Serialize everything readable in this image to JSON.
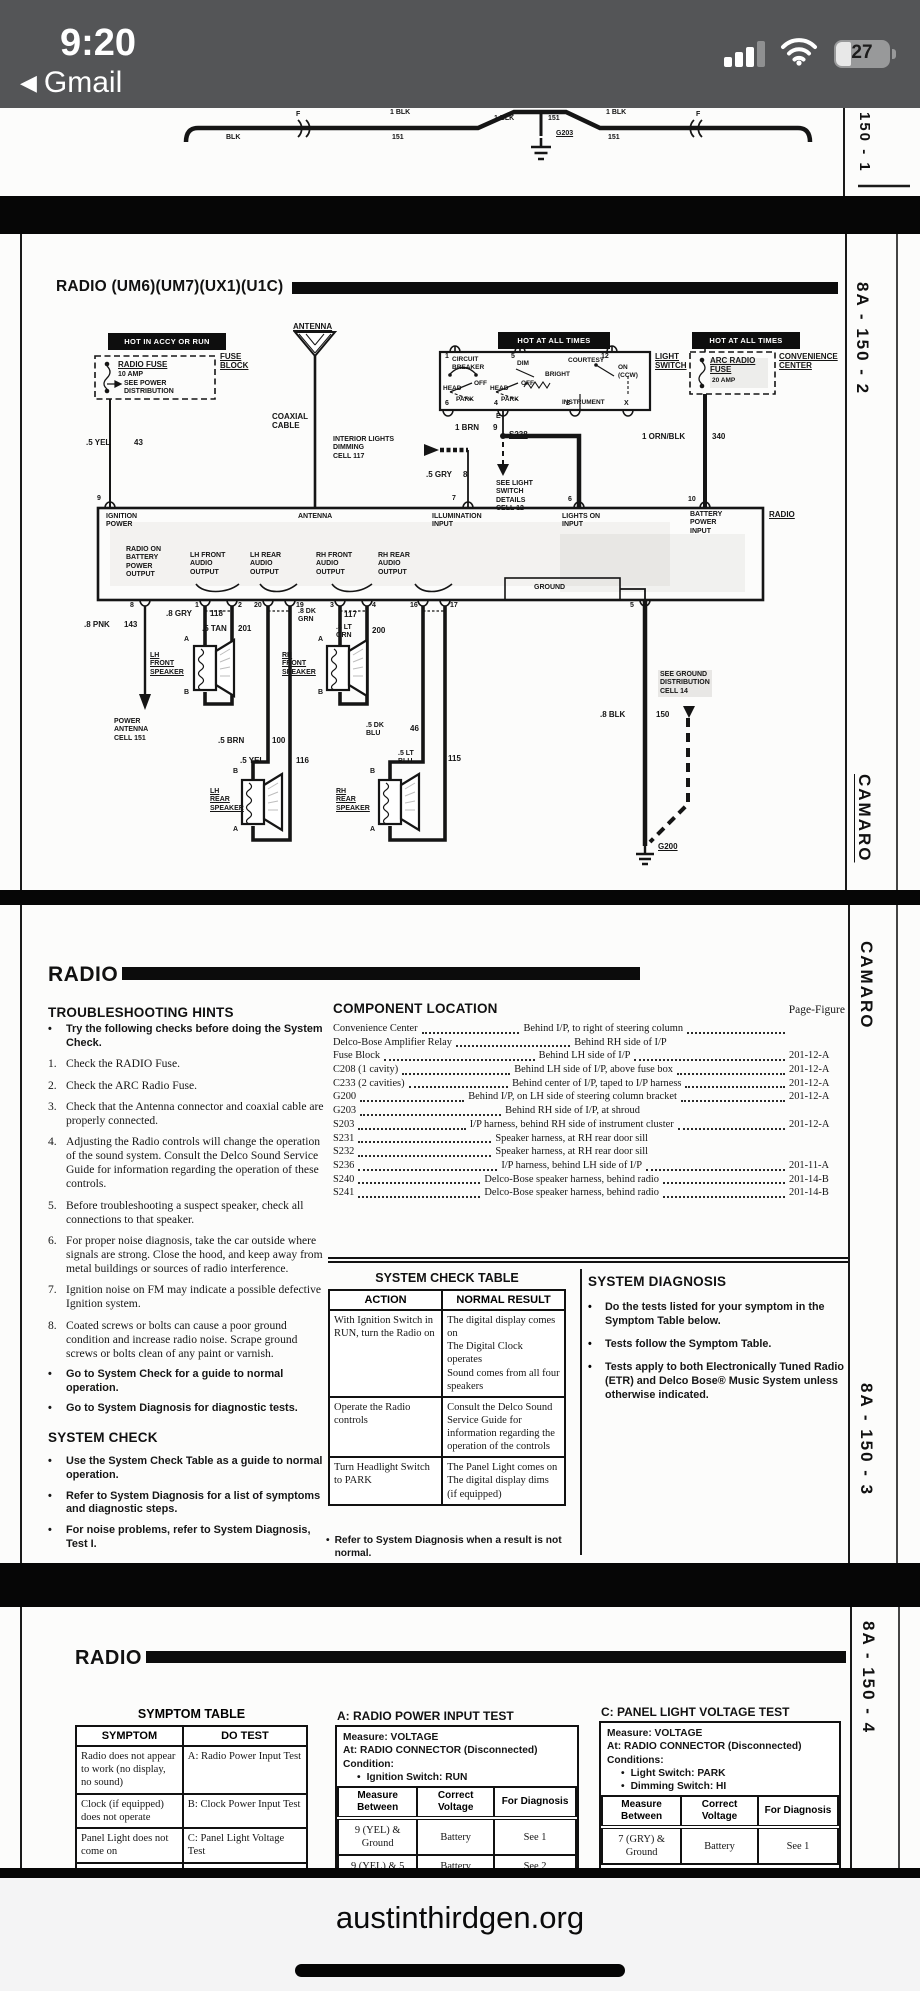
{
  "bullet": "•",
  "status": {
    "time": "9:20",
    "back": "Gmail",
    "battery": "27"
  },
  "bottom": {
    "url": "austinthirdgen.org"
  },
  "p1": {
    "page": "150 - 1",
    "f": "F",
    "blk": "BLK",
    "blk1": "1 BLK",
    "c151": "151",
    "g203": "G203"
  },
  "p2": {
    "title": "RADIO (UM6)(UM7)(UX1)(U1C)",
    "page": "8A - 150 - 2",
    "camaro": "CAMARO",
    "d": {
      "hot_accy": "HOT IN ACCY OR RUN",
      "fuse_block": "FUSE\nBLOCK",
      "radio_fuse": "RADIO FUSE",
      "amp10": "10 AMP",
      "see_power": "SEE POWER\nDISTRIBUTION",
      "antenna": "ANTENNA",
      "coax": "COAXIAL\nCABLE",
      "hot_all": "HOT AT ALL TIMES",
      "light_switch": "LIGHT\nSWITCH",
      "cb": "CIRCUIT\nBREAKER",
      "dim": "DIM",
      "bright": "BRIGHT",
      "courtesy": "COURTESY",
      "instrument": "INSTRUMENT",
      "on_ccw": "ON\n(CCW)",
      "head": "HEAD",
      "off": "OFF",
      "park": "PARK",
      "n1": "1",
      "n5": "5",
      "n12": "12",
      "n6": "6",
      "n4": "4",
      "n2": "2",
      "nx": "X",
      "ne": "E",
      "n7": "7",
      "n9": "9",
      "n10": "10",
      "arc_fuse": "ARC RADIO\nFUSE",
      "amp20": "20 AMP",
      "convenience": "CONVENIENCE\nCENTER",
      "yel43": ".5 YEL",
      "c43": "43",
      "gry8": ".5 GRY",
      "c8": "8",
      "interior": "INTERIOR LIGHTS\nDIMMING\nCELL 117",
      "brn9": "1 BRN",
      "c9": "9",
      "s238": "S238",
      "see_light": "SEE LIGHT\nSWITCH\nDETAILS\nCELL 12",
      "ornblk": "1 ORN/BLK",
      "c340": "340",
      "radio": "RADIO",
      "ign": "IGNITION\nPOWER",
      "ant_in": "ANTENNA",
      "illum": "ILLUMINATION\nINPUT",
      "lights_on": "LIGHTS ON\nINPUT",
      "batt": "BATTERY\nPOWER\nINPUT",
      "radio_on": "RADIO ON\nBATTERY\nPOWER\nOUTPUT",
      "lf": "LH FRONT\nAUDIO\nOUTPUT",
      "lr": "LH REAR\nAUDIO\nOUTPUT",
      "rf": "RH FRONT\nAUDIO\nOUTPUT",
      "rr": "RH REAR\nAUDIO\nOUTPUT",
      "gnd": "GROUND",
      "b8": "8",
      "b1": "1",
      "b2": "2",
      "b20": "20",
      "b19": "19",
      "b3": "3",
      "b4": "4",
      "b16": "16",
      "b17": "17",
      "b5": "5",
      "pnk": ".8 PNK",
      "c143": "143",
      "pwr_ant": "POWER\nANTENNA\nCELL 151",
      "gry118": ".8 GRY",
      "c118": "118",
      "tan201": ".5 TAN",
      "c201": "201",
      "lfs": "LH\nFRONT\nSPEAKER",
      "dkgrn": ".8 DK\nGRN",
      "c117": "117",
      "ltgrn": ".8 LT\nGRN",
      "c200": "200",
      "rfs": "RH\nFRONT\nSPEAKER",
      "brn100": ".5 BRN",
      "c100": "100",
      "yel116": ".5 YEL",
      "c116": "116",
      "lrs": "LH\nREAR\nSPEAKER",
      "dkblu": ".5 DK\nBLU",
      "c46": "46",
      "ltblu": ".5 LT\nBLU",
      "c115": "115",
      "rrs": "RH\nREAR\nSPEAKER",
      "ta": "A",
      "tb": "B",
      "blk150": ".8 BLK",
      "c150": "150",
      "see_gnd": "SEE GROUND\nDISTRIBUTION\nCELL 14",
      "g200": "G200"
    }
  },
  "p3": {
    "header": "RADIO",
    "th": "TROUBLESHOOTING HINTS",
    "hints": [
      {
        "m": "•",
        "t": "Try the following checks before doing the System Check."
      },
      {
        "m": "1.",
        "t": "Check the RADIO Fuse."
      },
      {
        "m": "2.",
        "t": "Check the ARC Radio Fuse."
      },
      {
        "m": "3.",
        "t": "Check that the Antenna connector and coaxial cable are properly connected."
      },
      {
        "m": "4.",
        "t": "Adjusting the Radio controls will change the operation of the sound system. Consult the Delco Sound Service Guide for information regarding the operation of these controls."
      },
      {
        "m": "5.",
        "t": "Before troubleshooting a suspect speaker, check all connections to that speaker."
      },
      {
        "m": "6.",
        "t": "For proper noise diagnosis, take the car outside where signals are strong. Close the hood, and keep away from metal buildings or sources of radio interference."
      },
      {
        "m": "7.",
        "t": "Ignition noise on FM may indicate a possible defective Ignition system."
      },
      {
        "m": "8.",
        "t": "Coated screws or bolts can cause a poor ground condition and increase radio noise. Scrape ground screws or bolts clean of any paint or varnish."
      },
      {
        "m": "•",
        "t": "Go to System Check for a guide to normal operation."
      },
      {
        "m": "•",
        "t": "Go to System Diagnosis for diagnostic tests."
      }
    ],
    "sc_title": "SYSTEM CHECK",
    "sc": [
      "Use the System Check Table as a guide to normal operation.",
      "Refer to System Diagnosis for a list of symptoms and diagnostic steps.",
      "For noise problems, refer to System Diagnosis, Test I."
    ],
    "cl_title": "COMPONENT LOCATION",
    "pf": "Page-Figure",
    "comps": [
      {
        "n": "Convenience Center",
        "l": "Behind I/P, to right of steering column",
        "p": "201-12-A"
      },
      {
        "n": "Delco-Bose Amplifier Relay",
        "l": "Behind RH side of I/P",
        "p": ""
      },
      {
        "n": "Fuse Block",
        "l": "Behind LH side of I/P",
        "p": "201-12-A"
      },
      {
        "n": "C208 (1 cavity)",
        "l": "Behind LH side of I/P, above fuse box",
        "p": "201-12-A"
      },
      {
        "n": "C233 (2 cavities)",
        "l": "Behind center of I/P, taped to I/P harness",
        "p": "201-12-A"
      },
      {
        "n": "G200",
        "l": "Behind I/P, on LH side of steering column bracket",
        "p": "201-12-A"
      },
      {
        "n": "G203",
        "l": "Behind RH side of I/P, at shroud",
        "p": ""
      },
      {
        "n": "S203",
        "l": "I/P harness, behind RH side of instrument cluster",
        "p": "201-12-A"
      },
      {
        "n": "S231",
        "l": "Speaker harness, at RH rear door sill",
        "p": ""
      },
      {
        "n": "S232",
        "l": "Speaker harness, at RH rear door sill",
        "p": ""
      },
      {
        "n": "S236",
        "l": "I/P harness, behind LH side of I/P",
        "p": "201-11-A"
      },
      {
        "n": "S240",
        "l": "Delco-Bose speaker harness, behind radio",
        "p": "201-14-B"
      },
      {
        "n": "S241",
        "l": "Delco-Bose speaker harness, behind radio",
        "p": "201-14-B"
      }
    ],
    "sct": {
      "title": "SYSTEM CHECK TABLE",
      "h1": "ACTION",
      "h2": "NORMAL RESULT",
      "rows": [
        {
          "a": "With Ignition Switch in RUN, turn the Radio on",
          "r": "The digital display comes on\nThe Digital Clock operates\nSound comes from all four speakers"
        },
        {
          "a": "Operate the Radio controls",
          "r": "Consult the Delco Sound Service Guide for information regarding the operation of the controls"
        },
        {
          "a": "Turn Headlight Switch to PARK",
          "r": "The Panel Light comes on\nThe digital display dims (if equipped)"
        }
      ],
      "note": "Refer to System Diagnosis when a result is not normal."
    },
    "sd": {
      "title": "SYSTEM DIAGNOSIS",
      "items": [
        "Do the tests listed for your symptom in the Symptom Table below.",
        "Tests follow the Symptom Table.",
        "Tests apply to both Electronically Tuned Radio (ETR) and Delco Bose® Music System unless otherwise indicated."
      ]
    },
    "camaro": "CAMARO",
    "page": "8A - 150 - 3"
  },
  "p4": {
    "header": "RADIO",
    "st": {
      "title": "SYMPTOM TABLE",
      "h1": "SYMPTOM",
      "h2": "DO TEST",
      "rows": [
        {
          "s": "Radio does not appear to work (no display, no sound)",
          "t": "A: Radio Power Input Test"
        },
        {
          "s": "Clock (if equipped) does not operate",
          "t": "B: Clock Power Input Test"
        },
        {
          "s": "Panel Light does not come on",
          "t": "C: Panel Light Voltage Test"
        },
        {
          "s": "Display dimming",
          "t": "D: Display Dimming"
        }
      ]
    },
    "ta": {
      "title": "A: RADIO POWER INPUT TEST",
      "m": "Measure: VOLTAGE",
      "at": "At: RADIO CONNECTOR (Disconnected)",
      "c": "Condition:",
      "cl": [
        "Ignition Switch: RUN"
      ],
      "h1": "Measure\nBetween",
      "h2": "Correct\nVoltage",
      "h3": "For Diagnosis",
      "rows": [
        {
          "b": "9 (YEL) & Ground",
          "v": "Battery",
          "d": "See 1"
        },
        {
          "b": "9 (YEL) & 5",
          "v": "Battery",
          "d": "See 2"
        }
      ]
    },
    "tc": {
      "title": "C: PANEL LIGHT VOLTAGE TEST",
      "m": "Measure: VOLTAGE",
      "at": "At: RADIO CONNECTOR (Disconnected)",
      "c": "Conditions:",
      "cl": [
        "Light Switch: PARK",
        "Dimming Switch: HI"
      ],
      "h1": "Measure\nBetween",
      "h2": "Correct\nVoltage",
      "h3": "For Diagnosis",
      "rows": [
        {
          "b": "7 (GRY) & Ground",
          "v": "Battery",
          "d": "See 1"
        }
      ],
      "note": "If the voltage is correct, remove Radio for"
    },
    "page": "8A - 150 - 4"
  }
}
